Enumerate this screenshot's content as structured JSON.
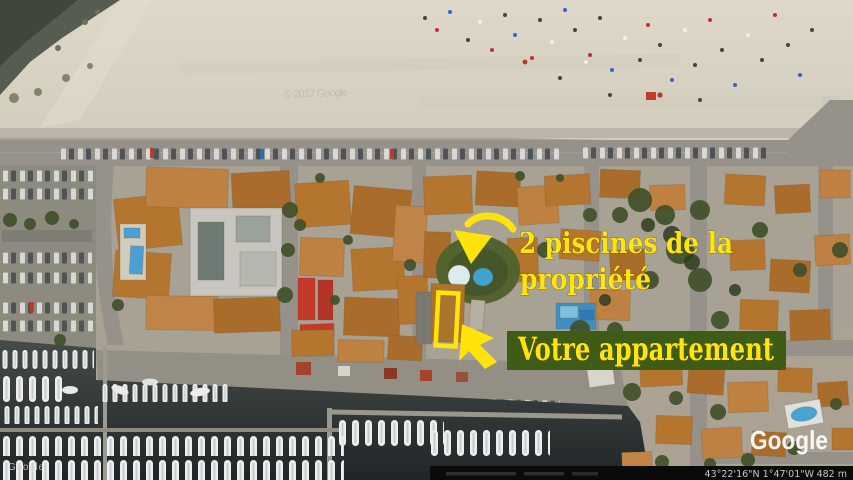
{
  "annotations": {
    "pools_label_line1": "2 piscines de la",
    "pools_label_line2": "propriété",
    "apartment_label": "Votre appartement",
    "colors": {
      "label_yellow": "#ffe40e",
      "box_green": "#3e5c16",
      "arrow_yellow": "#ffe30b"
    }
  },
  "branding": {
    "logo": "Google",
    "watermark_small": "Google",
    "ghost_watermark": "© 2017 Google"
  },
  "status_bar": {
    "coordinates": "43°22'16\"N 1°47'01\"W",
    "elevation": "482 m"
  }
}
